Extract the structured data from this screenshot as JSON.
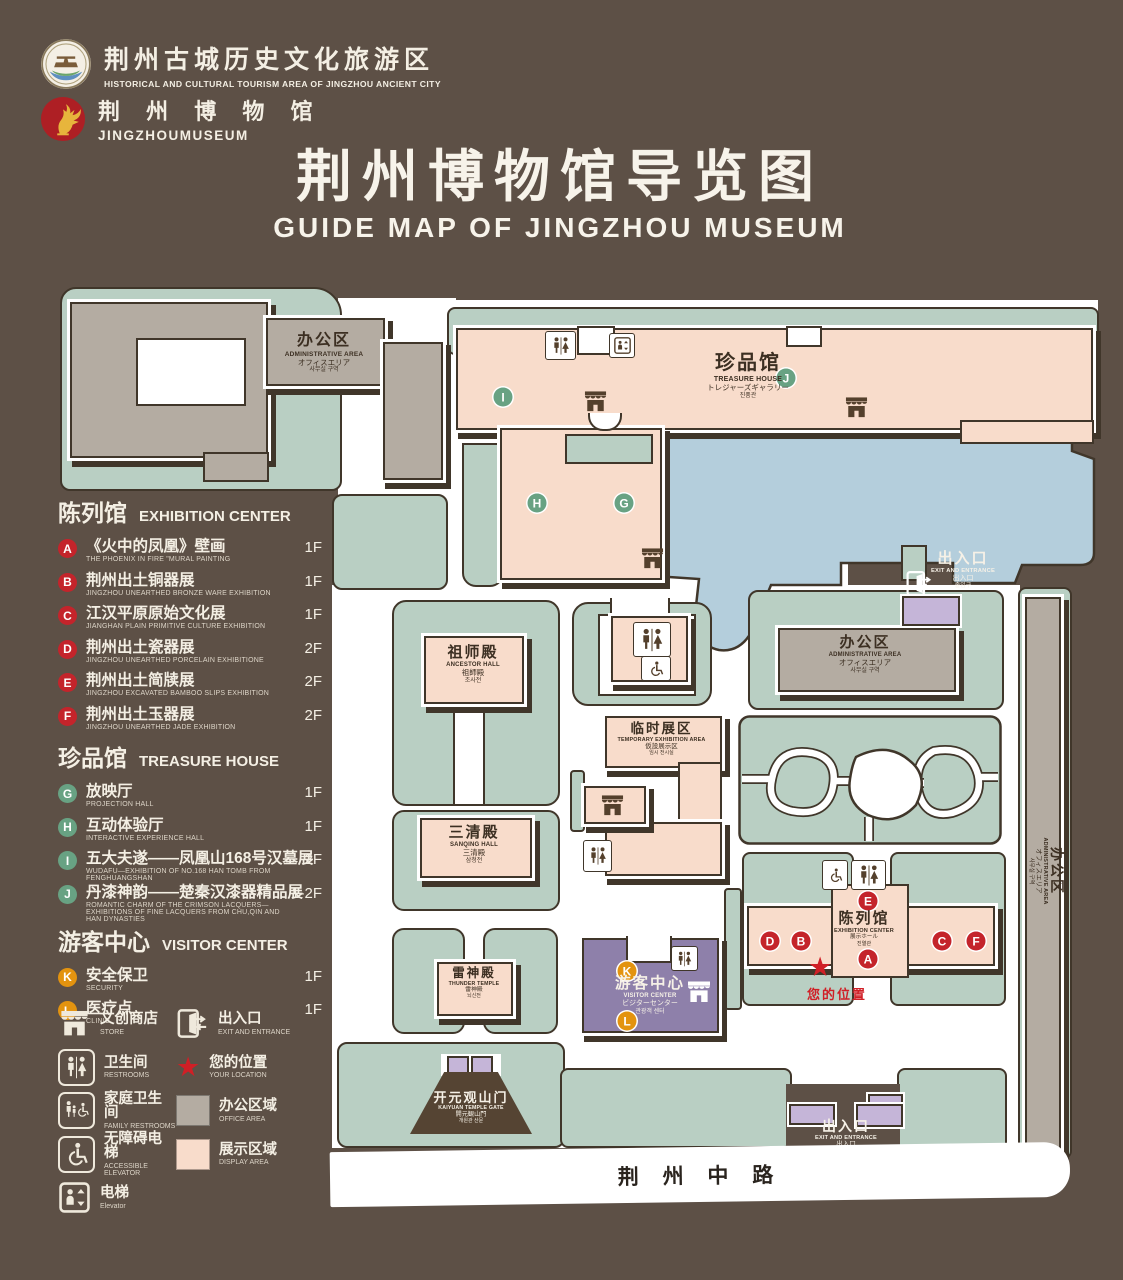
{
  "header": {
    "logo1": {
      "zh": "荆州古城历史文化旅游区",
      "en": "HISTORICAL AND CULTURAL TOURISM AREA OF JINGZHOU ANCIENT CITY"
    },
    "logo2": {
      "zh": "荆 州 博 物 馆",
      "en": "JINGZHOUMUSEUM"
    },
    "title": {
      "zh": "荆州博物馆导览图",
      "en": "GUIDE MAP OF JINGZHOU MUSEUM"
    }
  },
  "legend": {
    "sections": [
      {
        "id": "exhibition-center",
        "zh": "陈列馆",
        "en": "EXHIBITION CENTER",
        "badge_color": "#c4242b",
        "items": [
          {
            "letter": "A",
            "zh": "《火中的凤凰》壁画",
            "en": "THE PHOENIX IN FIRE \"MURAL PAINTING",
            "floor": "1F"
          },
          {
            "letter": "B",
            "zh": "荆州出土铜器展",
            "en": "JINGZHOU UNEARTHED BRONZE WARE EXHIBITION",
            "floor": "1F"
          },
          {
            "letter": "C",
            "zh": "江汉平原原始文化展",
            "en": "JIANGHAN PLAIN PRIMITIVE CULTURE EXHIBITION",
            "floor": "1F"
          },
          {
            "letter": "D",
            "zh": "荆州出土瓷器展",
            "en": "JINGZHOU UNEARTHED PORCELAIN EXHIBITIONE",
            "floor": "2F"
          },
          {
            "letter": "E",
            "zh": "荆州出土简牍展",
            "en": "JINGZHOU EXCAVATED BAMBOO SLIPS EXHIBITION",
            "floor": "2F"
          },
          {
            "letter": "F",
            "zh": "荆州出土玉器展",
            "en": "JINGZHOU UNEARTHED JADE EXHIBITION",
            "floor": "2F"
          }
        ]
      },
      {
        "id": "treasure-house",
        "zh": "珍品馆",
        "en": "TREASURE HOUSE",
        "badge_color": "#68a283",
        "items": [
          {
            "letter": "G",
            "zh": "放映厅",
            "en": "PROJECTION HALL",
            "floor": "1F"
          },
          {
            "letter": "H",
            "zh": "互动体验厅",
            "en": "INTERACTIVE EXPERIENCE HALL",
            "floor": "1F"
          },
          {
            "letter": "I",
            "zh": "五大夫遂——凤凰山168号汉墓展",
            "en": "WUDAFU—EXHIBITION OF NO.168 HAN TOMB FROM FENGHUANGSHAN",
            "floor": "2F"
          },
          {
            "letter": "J",
            "zh": "丹漆神韵——楚秦汉漆器精品展",
            "en": "ROMANTIC CHARM OF THE CRIMSON LACQUERS—EXHIBITIONS OF FINE LACQUERS FROM CHU,QIN AND HAN DYNASTIES",
            "floor": "1-2F"
          }
        ]
      },
      {
        "id": "visitor-center",
        "zh": "游客中心",
        "en": "VISITOR CENTER",
        "badge_color": "#e3930f",
        "items": [
          {
            "letter": "K",
            "zh": "安全保卫",
            "en": "SECURITY",
            "floor": "1F"
          },
          {
            "letter": "L",
            "zh": "医疗点",
            "en": "CLINIC",
            "floor": "1F"
          }
        ]
      }
    ],
    "symbols_left": [
      {
        "icon": "store-icon",
        "zh": "文创商店",
        "en": "STORE"
      },
      {
        "icon": "restrooms-icon",
        "zh": "卫生间",
        "en": "RESTROOMS"
      },
      {
        "icon": "family-restrooms-icon",
        "zh": "家庭卫生间",
        "en": "FAMILY RESTROOMS"
      },
      {
        "icon": "accessible-elevator-icon",
        "zh": "无障碍电梯",
        "en": "ACCESSIBLE ELEVATOR"
      },
      {
        "icon": "elevator-icon",
        "zh": "电梯",
        "en": "Elevator"
      }
    ],
    "symbols_right": [
      {
        "icon": "exit-entrance-icon",
        "zh": "出入口",
        "en": "EXIT AND ENTRANCE"
      },
      {
        "icon": "your-location-icon",
        "zh": "您的位置",
        "en": "YOUR LOCATION"
      },
      {
        "icon": "office-area-swatch",
        "zh": "办公区域",
        "en": "OFFICE AREA"
      },
      {
        "icon": "display-area-swatch",
        "zh": "展示区域",
        "en": "DISPLAY AREA"
      }
    ]
  },
  "map": {
    "buildings": {
      "admin_nw": {
        "zh": "办公区",
        "en": "ADMINISTRATIVE AREA",
        "ja": "オフィスエリア",
        "ko": "사무실 구역"
      },
      "treasure": {
        "zh": "珍品馆",
        "en": "TREASURE HOUSE",
        "ja": "トレジャーズギャラリー",
        "ko": "진품관"
      },
      "ancestor": {
        "zh": "祖师殿",
        "en": "ANCESTOR HALL",
        "ja": "祖師殿",
        "ko": "조사전"
      },
      "sanqing": {
        "zh": "三清殿",
        "en": "SANQING HALL",
        "ja": "三清殿",
        "ko": "삼청전"
      },
      "thunder": {
        "zh": "雷神殿",
        "en": "THUNDER TEMPLE",
        "ja": "雷神殿",
        "ko": "뇌신전"
      },
      "temporary": {
        "zh": "临时展区",
        "en": "TEMPORARY EXHIBITION AREA",
        "ja": "仮設展示区",
        "ko": "임시 전시실"
      },
      "admin_e": {
        "zh": "办公区",
        "en": "ADMINISTRATIVE AREA",
        "ja": "オフィスエリア",
        "ko": "사무실 구역"
      },
      "admin_strip": {
        "zh": "办公区",
        "en": "ADMINISTRATIVE AREA",
        "ja": "オフィスエリア",
        "ko": "사무실 구역"
      },
      "exhibition": {
        "zh": "陈列馆",
        "en": "EXHIBITION CENTER",
        "ja": "展示ホール",
        "ko": "진열관"
      },
      "visitor": {
        "zh": "游客中心",
        "en": "VISITOR CENTER",
        "ja": "ビジターセンター",
        "ko": "관광객 센터"
      },
      "gate": {
        "zh": "开元观山门",
        "en": "KAIYUAN TEMPLE GATE",
        "ja": "開元観山門",
        "ko": "개원관 산문"
      }
    },
    "exit_ne": {
      "zh": "出入口",
      "en": "EXIT AND ENTRANCE",
      "ja": "出入口",
      "ko": "출입구"
    },
    "exit_s": {
      "zh": "出入口",
      "en": "EXIT AND ENTRANCE",
      "ja": "出入口",
      "ko": "출입구"
    },
    "road": "荆 州 中 路",
    "your_location": "您的位置",
    "badge_letters": {
      "a": "A",
      "b": "B",
      "c": "C",
      "d": "D",
      "e": "E",
      "f": "F",
      "g": "G",
      "h": "H",
      "i": "I",
      "j": "J",
      "k": "K",
      "l": "L"
    }
  },
  "colors": {
    "background": "#5d5046",
    "lawn": "#b9cfc3",
    "display_area": "#f8dccb",
    "office_area": "#b4aca2",
    "pond": "#b4cedc",
    "visitor_center": "#8e80aa",
    "gate_purple": "#c5b5d8",
    "badge_red": "#c4242b",
    "badge_green": "#68a283",
    "badge_orange": "#e3930f",
    "location_red": "#d01f26",
    "outline": "#40362a"
  }
}
